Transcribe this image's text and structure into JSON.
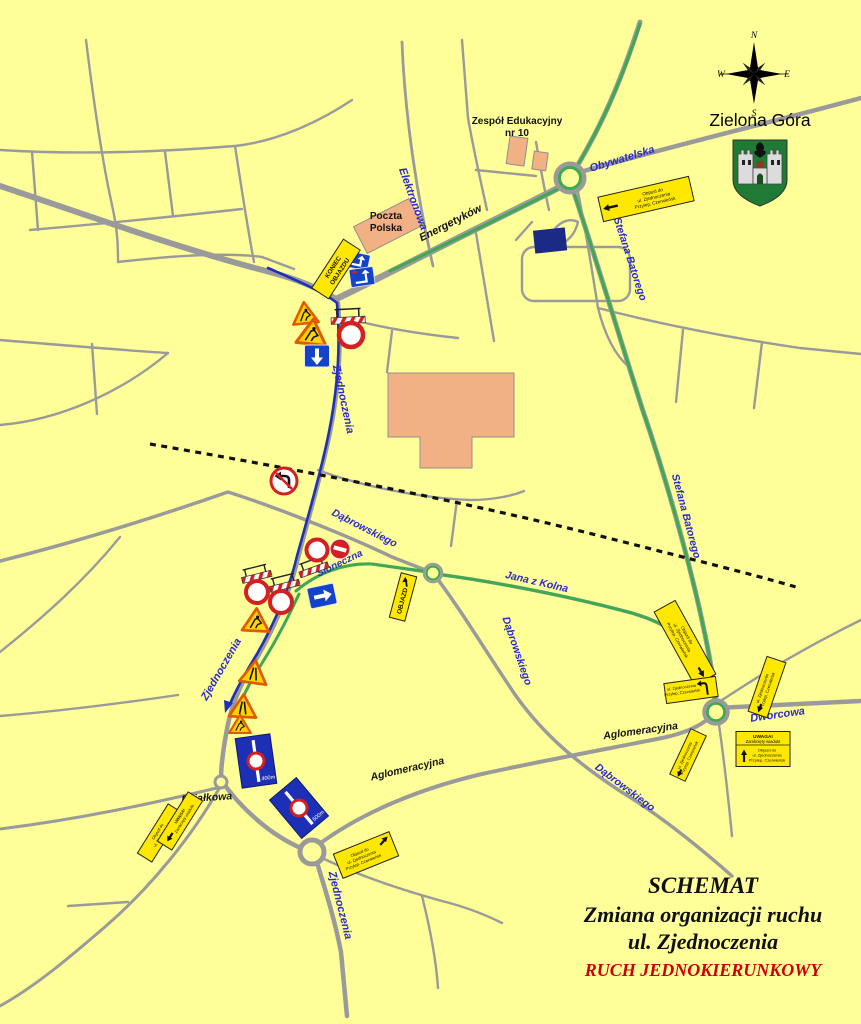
{
  "map": {
    "city": "Zielona Góra",
    "compass": {
      "n": "N",
      "e": "E",
      "s": "S",
      "w": "W"
    },
    "title": {
      "line1": "SCHEMAT",
      "line2": "Zmiana organizacji ruchu",
      "line3": "ul. Zjednoczenia",
      "line4": "RUCH JEDNOKIERUNKOWY"
    },
    "landmarks": {
      "school_line1": "Zespół Edukacyjny",
      "school_line2": "nr 10",
      "post_line1": "Poczta",
      "post_line2": "Polska"
    },
    "streets": {
      "elektronowa": "Elektronowa",
      "energetykow": "Energetyków",
      "obywatelska": "Obywatelska",
      "batorego_top": "Stefana Batorego",
      "batorego_mid": "Stefana Batorego",
      "zjednoczenia_n": "Zjednoczenia",
      "zjednoczenia_mid": "Zjednoczenia",
      "zjednoczenia_s": "Zjednoczenia",
      "dabrowskiego_up": "Dąbrowskiego",
      "dabrowskiego_mid": "Dąbrowskiego",
      "dabrowskiego_se": "Dąbrowskiego",
      "sloneczna": "Słoneczna",
      "jana_z_kolna": "Jana z Kolna",
      "dworcowa": "Dworcowa",
      "aglomeracyjna_w": "Aglomeracyjna",
      "aglomeracyjna_e": "Aglomeracyjna",
      "dzialkowa": "Działkowa"
    },
    "boards": {
      "koniec_line1": "KONIEC",
      "koniec_line2": "OBJAZDU",
      "objazd": "OBJAZD",
      "detour_line1": "Objazd do",
      "detour_line2": "ul. Zjednoczenia",
      "detour_line3": "Przylep, Czerwieńsk",
      "uwaga_line1": "UWAGA!",
      "uwaga_line2": "Zamknięty wiadukt"
    },
    "signs": {
      "d400": "400m",
      "d600": "600m"
    },
    "colors": {
      "background": "#FFFF99",
      "road_gray": "#9A9A9A",
      "route_green": "#3FA852",
      "route_blue": "#2130B8",
      "sign_blue": "#1243C8",
      "sign_red": "#D42020",
      "board_yellow": "#FFE800",
      "street_label_blue": "#2B2BC8",
      "accent_red": "#CC0000"
    }
  }
}
